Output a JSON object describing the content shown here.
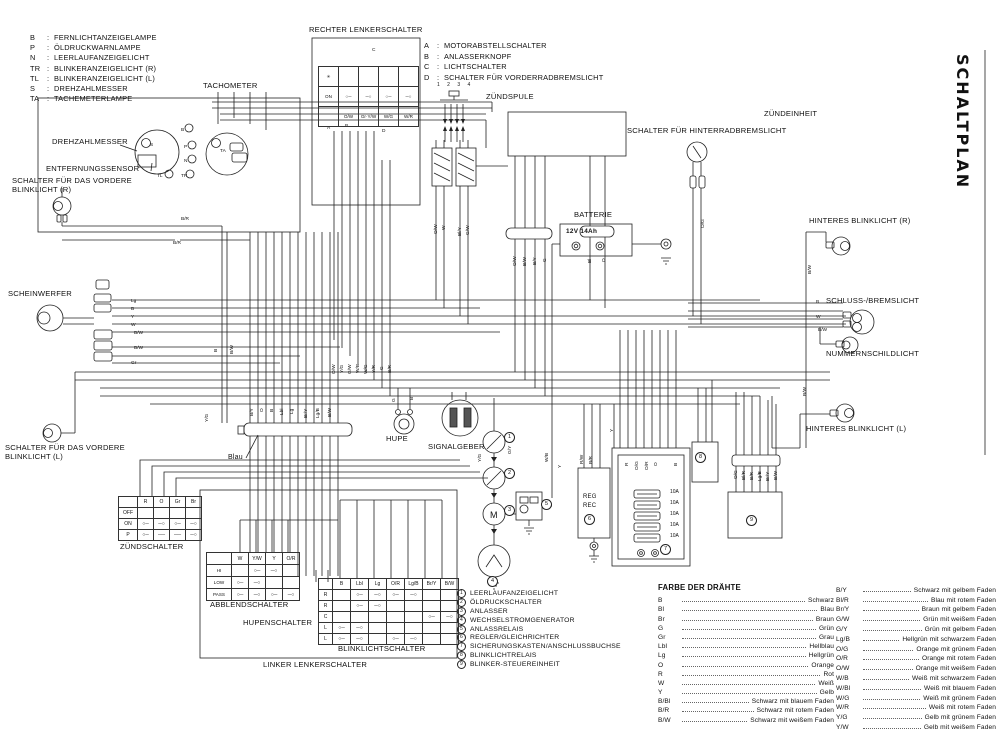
{
  "title": {
    "vertical": "SCHALTPLAN"
  },
  "legend_lamps": {
    "items": [
      {
        "key": "B",
        "label": "FERNLICHTANZEIGELAMPE"
      },
      {
        "key": "P",
        "label": "ÖLDRUCKWARNLAMPE"
      },
      {
        "key": "N",
        "label": "LEERLAUFANZEIGELICHT"
      },
      {
        "key": "TR",
        "label": "BLINKERANZEIGELICHT (R)"
      },
      {
        "key": "TL",
        "label": "BLINKERANZEIGELICHT (L)"
      },
      {
        "key": "S",
        "label": "DREHZAHLMESSER"
      },
      {
        "key": "TA",
        "label": "TACHEMETERLAMPE"
      }
    ]
  },
  "legend_switches": {
    "items": [
      {
        "key": "A",
        "label": "MOTORABSTELLSCHALTER"
      },
      {
        "key": "B",
        "label": "ANLASSERKNOPF"
      },
      {
        "key": "C",
        "label": "LICHTSCHALTER"
      },
      {
        "key": "D",
        "label": "SCHALTER FÜR VORDERRADBREMSLICHT"
      }
    ]
  },
  "numbered_legend": {
    "items": [
      {
        "num": "1",
        "label": "LEERLAUFANZEIGELICHT"
      },
      {
        "num": "2",
        "label": "ÖLDRUCKSCHALTER"
      },
      {
        "num": "3",
        "label": "ANLASSER"
      },
      {
        "num": "4",
        "label": "WECHSELSTROMGENERATOR"
      },
      {
        "num": "5",
        "label": "ANLASSRELAIS"
      },
      {
        "num": "6",
        "label": "REGLER/GLEICHRICHTER"
      },
      {
        "num": "7",
        "label": "SICHERUNGSKASTEN/ANSCHLUSSBUCHSE"
      },
      {
        "num": "8",
        "label": "BLINKLICHTRELAIS"
      },
      {
        "num": "9",
        "label": "BLINKER-STEUEREINHEIT"
      }
    ]
  },
  "wire_colors": {
    "title": "FARBE DER DRÄHTE",
    "left": [
      {
        "code": "B",
        "name": "Schwarz"
      },
      {
        "code": "Bl",
        "name": "Blau"
      },
      {
        "code": "Br",
        "name": "Braun"
      },
      {
        "code": "G",
        "name": "Grün"
      },
      {
        "code": "Gr",
        "name": "Grau"
      },
      {
        "code": "Lbl",
        "name": "Hellblau"
      },
      {
        "code": "Lg",
        "name": "Hellgrün"
      },
      {
        "code": "O",
        "name": "Orange"
      },
      {
        "code": "R",
        "name": "Rot"
      },
      {
        "code": "W",
        "name": "Weiß"
      },
      {
        "code": "Y",
        "name": "Gelb"
      },
      {
        "code": "B/Bl",
        "name": "Schwarz mit blauem Faden"
      },
      {
        "code": "B/R",
        "name": "Schwarz mit rotem Faden"
      },
      {
        "code": "B/W",
        "name": "Schwarz mit weißem Faden"
      }
    ],
    "right": [
      {
        "code": "B/Y",
        "name": "Schwarz mit gelbem Faden"
      },
      {
        "code": "Bl/R",
        "name": "Blau mit rotem Faden"
      },
      {
        "code": "Br/Y",
        "name": "Braun mit gelbem Faden"
      },
      {
        "code": "G/W",
        "name": "Grün mit weißem Faden"
      },
      {
        "code": "G/Y",
        "name": "Grün mit gelbem Faden"
      },
      {
        "code": "Lg/B",
        "name": "Hellgrün mit schwarzem Faden"
      },
      {
        "code": "O/G",
        "name": "Orange mit grünem Faden"
      },
      {
        "code": "O/R",
        "name": "Orange mit rotem Faden"
      },
      {
        "code": "O/W",
        "name": "Orange mit weißem Faden"
      },
      {
        "code": "W/B",
        "name": "Weiß mit schwarzem Faden"
      },
      {
        "code": "W/Bl",
        "name": "Weiß mit blauem Faden"
      },
      {
        "code": "W/G",
        "name": "Weiß mit grünem Faden"
      },
      {
        "code": "W/R",
        "name": "Weiß mit rotem Faden"
      },
      {
        "code": "Y/G",
        "name": "Gelb mit grünem Faden"
      },
      {
        "code": "Y/W",
        "name": "Gelb mit weißem Faden"
      }
    ]
  },
  "labels": {
    "tachometer": "TACHOMETER",
    "drehzahlmesser": "DREHZAHLMESSER",
    "entfernungssensor": "ENTFERNUNGSSENSOR",
    "blinklicht_vorne_r": "SCHALTER FÜR DAS VORDERE BLINKLICHT (R)",
    "scheinwerfer": "SCHEINWERFER",
    "blinklicht_vorne_l": "SCHALTER FÜR DAS VORDERE BLINKLICHT (L)",
    "zuendschalter": "ZÜNDSCHALTER",
    "rechter_lenkerschalter": "RECHTER LENKERSCHALTER",
    "zuendspule": "ZÜNDSPULE",
    "zuendspule_pins": "1 2 3 4",
    "zuendeinheit": "ZÜNDEINHEIT",
    "batterie": "BATTERIE",
    "schalter_hinterradbremslicht": "SCHALTER FÜR HINTERRADBREMSLICHT",
    "hinteres_blinklicht_r": "HINTERES BLINKLICHT (R)",
    "schluss_bremslicht": "SCHLUSS-/BREMSLICHT",
    "nummernschildlicht": "NUMMERNSCHILDLICHT",
    "hinteres_blinklicht_l": "HINTERES BLINKLICHT (L)",
    "hupe": "HUPE",
    "signalgeber": "SIGNALGEBER",
    "blau": "Blau",
    "abblendschalter": "ABBLENDSCHALTER",
    "hupenschalter": "HUPENSCHALTER",
    "blinklichtschalter": "BLINKLICHTSCHALTER",
    "linker_lenkerschalter": "LINKER LENKERSCHALTER"
  },
  "battery": {
    "label": "BATTERIE",
    "rating": "12V 14Ah"
  },
  "fuses": [
    "10A",
    "10A",
    "10A",
    "10A",
    "10A"
  ],
  "tables": {
    "zuendschalter": {
      "cols": [
        "",
        "R",
        "O",
        "Gr",
        "Br"
      ],
      "rows": [
        [
          "OFF",
          "",
          "",
          "",
          ""
        ],
        [
          "ON",
          "○─",
          "─○",
          "○─",
          "─○"
        ],
        [
          "P",
          "○─",
          "──",
          "──",
          "─○"
        ]
      ]
    },
    "rechter_lenkerschalter": {
      "cols": null,
      "rows": [
        [
          "✳",
          "",
          "",
          "",
          ""
        ],
        [
          "ON",
          "○─",
          "─○",
          "○─",
          "─○"
        ],
        [
          "",
          "O/W",
          "Gr·Y/W",
          "W/G",
          "W/R"
        ]
      ]
    },
    "abblendschalter": {
      "cols": [
        "",
        "W",
        "Y/W",
        "Y",
        "O/R"
      ],
      "rows": [
        [
          "HI",
          "",
          "○─",
          "─○",
          ""
        ],
        [
          "LOW",
          "○─",
          "─○",
          "",
          ""
        ],
        [
          "PASS",
          "○─",
          "─○",
          "○─",
          "─○"
        ]
      ]
    },
    "blinklichtschalter": {
      "cols": [
        "",
        "B",
        "Lbl",
        "Lg",
        "O/R",
        "Lg/B",
        "Br/Y",
        "B/W"
      ],
      "rows": [
        [
          "R",
          "",
          "○─",
          "─○",
          "○─",
          "─○",
          "",
          ""
        ],
        [
          "R",
          "",
          "○─",
          "─○",
          "",
          "",
          "",
          ""
        ],
        [
          "C",
          "",
          "",
          "",
          "",
          "",
          "○─",
          "─○"
        ],
        [
          "L",
          "○─",
          "─○",
          "",
          "",
          "",
          "",
          ""
        ],
        [
          "L",
          "○─",
          "─○",
          "",
          "○─",
          "─○",
          "",
          ""
        ]
      ]
    }
  },
  "reg_box": {
    "line1": "REG",
    "line2": "REC"
  },
  "circled_refs": [
    {
      "n": "1",
      "x": 509,
      "y": 437
    },
    {
      "n": "2",
      "x": 509,
      "y": 473
    },
    {
      "n": "3",
      "x": 509,
      "y": 510
    },
    {
      "n": "4",
      "x": 492,
      "y": 581
    },
    {
      "n": "5",
      "x": 546,
      "y": 504
    },
    {
      "n": "6",
      "x": 589,
      "y": 519
    },
    {
      "n": "7",
      "x": 665,
      "y": 549
    },
    {
      "n": "8",
      "x": 700,
      "y": 457
    },
    {
      "n": "9",
      "x": 751,
      "y": 520
    }
  ],
  "wire_labels": [
    {
      "t": "S",
      "x": 150,
      "y": 146
    },
    {
      "t": "TA",
      "x": 220,
      "y": 152
    },
    {
      "t": "B",
      "x": 181,
      "y": 131
    },
    {
      "t": "P",
      "x": 184,
      "y": 148
    },
    {
      "t": "N",
      "x": 184,
      "y": 162
    },
    {
      "t": "TL",
      "x": 157,
      "y": 177
    },
    {
      "t": "TR",
      "x": 181,
      "y": 177
    },
    {
      "t": "C",
      "x": 372,
      "y": 51
    },
    {
      "t": "A",
      "x": 327,
      "y": 129
    },
    {
      "t": "B",
      "x": 345,
      "y": 127
    },
    {
      "t": "D",
      "x": 382,
      "y": 132
    },
    {
      "t": "M",
      "x": 490,
      "y": 518,
      "s": 9
    },
    {
      "t": "B/R",
      "x": 181,
      "y": 220
    },
    {
      "t": "B/R",
      "x": 173,
      "y": 244
    },
    {
      "t": "Lg",
      "x": 131,
      "y": 302
    },
    {
      "t": "B",
      "x": 131,
      "y": 310
    },
    {
      "t": "Y",
      "x": 131,
      "y": 318
    },
    {
      "t": "W",
      "x": 131,
      "y": 326
    },
    {
      "t": "B/W",
      "x": 134,
      "y": 334
    },
    {
      "t": "B/W",
      "x": 134,
      "y": 349
    },
    {
      "t": "Gr",
      "x": 131,
      "y": 364
    },
    {
      "t": "B",
      "x": 217,
      "y": 352,
      "v": 1
    },
    {
      "t": "B/W",
      "x": 233,
      "y": 354,
      "v": 1
    },
    {
      "t": "Y/G",
      "x": 208,
      "y": 422,
      "v": 1
    },
    {
      "t": "B/Y",
      "x": 253,
      "y": 416,
      "v": 1
    },
    {
      "t": "O",
      "x": 263,
      "y": 412,
      "v": 1
    },
    {
      "t": "B",
      "x": 273,
      "y": 412,
      "v": 1
    },
    {
      "t": "Lbl",
      "x": 283,
      "y": 415,
      "v": 1
    },
    {
      "t": "Lg",
      "x": 293,
      "y": 414,
      "v": 1
    },
    {
      "t": "Br/Y",
      "x": 307,
      "y": 418,
      "v": 1
    },
    {
      "t": "Lg/B",
      "x": 319,
      "y": 418,
      "v": 1
    },
    {
      "t": "B/W",
      "x": 331,
      "y": 417,
      "v": 1
    },
    {
      "t": "O/W",
      "x": 335,
      "y": 374,
      "v": 1
    },
    {
      "t": "Y/G",
      "x": 343,
      "y": 373,
      "v": 1
    },
    {
      "t": "G/W",
      "x": 351,
      "y": 374,
      "v": 1
    },
    {
      "t": "W/B",
      "x": 359,
      "y": 373,
      "v": 1
    },
    {
      "t": "W/G",
      "x": 367,
      "y": 374,
      "v": 1
    },
    {
      "t": "Y/R",
      "x": 375,
      "y": 373,
      "v": 1
    },
    {
      "t": "G",
      "x": 383,
      "y": 370,
      "v": 1
    },
    {
      "t": "B/R",
      "x": 391,
      "y": 373,
      "v": 1
    },
    {
      "t": "O/W",
      "x": 437,
      "y": 234,
      "v": 1
    },
    {
      "t": "W",
      "x": 445,
      "y": 230,
      "v": 1
    },
    {
      "t": "Bl/Y",
      "x": 461,
      "y": 236,
      "v": 1
    },
    {
      "t": "G/W",
      "x": 469,
      "y": 235,
      "v": 1
    },
    {
      "t": "O/W",
      "x": 516,
      "y": 266,
      "v": 1
    },
    {
      "t": "B/W",
      "x": 526,
      "y": 266,
      "v": 1
    },
    {
      "t": "B/Y",
      "x": 536,
      "y": 265,
      "v": 1
    },
    {
      "t": "G",
      "x": 546,
      "y": 262,
      "v": 1
    },
    {
      "t": "Bl",
      "x": 591,
      "y": 263,
      "v": 1
    },
    {
      "t": "O",
      "x": 605,
      "y": 262,
      "v": 1
    },
    {
      "t": "O/G",
      "x": 704,
      "y": 228,
      "v": 1
    },
    {
      "t": "G/Y",
      "x": 511,
      "y": 454,
      "v": 1
    },
    {
      "t": "Y/G",
      "x": 481,
      "y": 462,
      "v": 1
    },
    {
      "t": "W/B",
      "x": 548,
      "y": 462,
      "v": 1
    },
    {
      "t": "Y",
      "x": 561,
      "y": 468,
      "v": 1
    },
    {
      "t": "R/W",
      "x": 583,
      "y": 464,
      "v": 1
    },
    {
      "t": "B/R",
      "x": 592,
      "y": 464,
      "v": 1
    },
    {
      "t": "R",
      "x": 628,
      "y": 466,
      "v": 1
    },
    {
      "t": "O/G",
      "x": 638,
      "y": 470,
      "v": 1
    },
    {
      "t": "O/R",
      "x": 648,
      "y": 470,
      "v": 1
    },
    {
      "t": "O",
      "x": 657,
      "y": 466,
      "v": 1
    },
    {
      "t": "B",
      "x": 677,
      "y": 466,
      "v": 1
    },
    {
      "t": "O/G",
      "x": 737,
      "y": 479,
      "v": 1
    },
    {
      "t": "Bl/R",
      "x": 745,
      "y": 480,
      "v": 1
    },
    {
      "t": "B/R",
      "x": 753,
      "y": 480,
      "v": 1
    },
    {
      "t": "Lg/B",
      "x": 761,
      "y": 481,
      "v": 1
    },
    {
      "t": "Br/Y",
      "x": 769,
      "y": 481,
      "v": 1
    },
    {
      "t": "B/W",
      "x": 777,
      "y": 480,
      "v": 1
    },
    {
      "t": "B/W",
      "x": 811,
      "y": 274,
      "v": 1
    },
    {
      "t": "B",
      "x": 816,
      "y": 303
    },
    {
      "t": "W",
      "x": 816,
      "y": 318
    },
    {
      "t": "B/W",
      "x": 818,
      "y": 331
    },
    {
      "t": "B/W",
      "x": 806,
      "y": 396,
      "v": 1
    },
    {
      "t": "Y",
      "x": 613,
      "y": 432,
      "v": 1
    },
    {
      "t": "G",
      "x": 395,
      "y": 402,
      "v": 1
    },
    {
      "t": "B",
      "x": 413,
      "y": 400,
      "v": 1
    }
  ]
}
